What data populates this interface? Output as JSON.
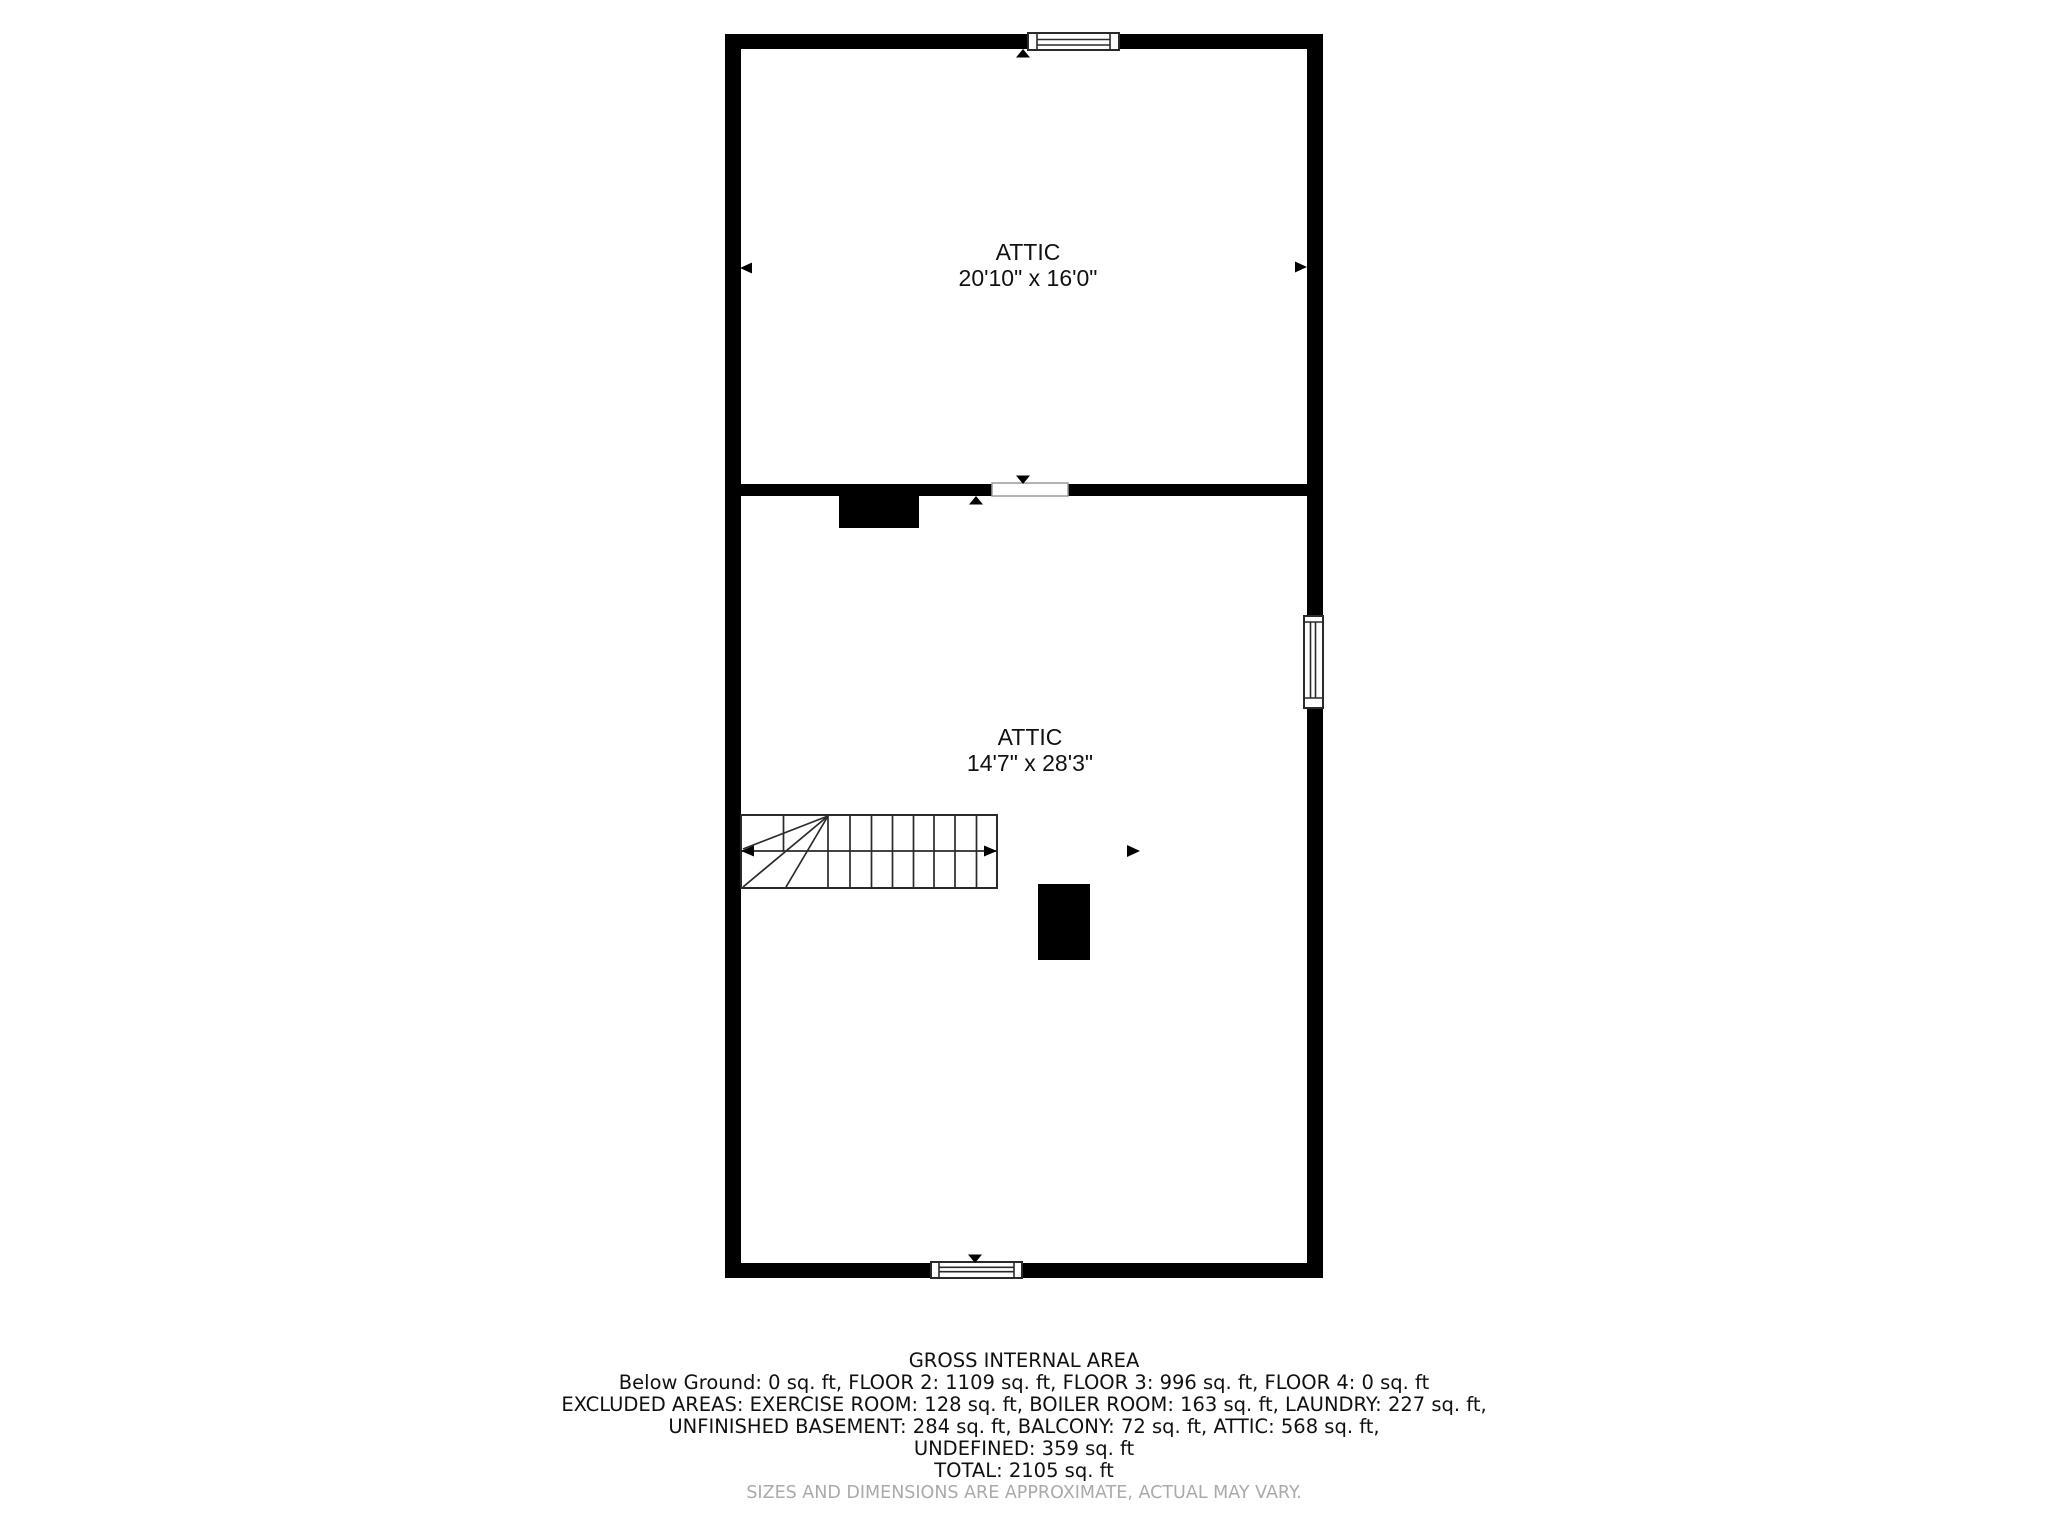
{
  "floor_plan": {
    "rooms": [
      {
        "name": "ATTIC",
        "dimensions": "20'10\" x 16'0\""
      },
      {
        "name": "ATTIC",
        "dimensions": "14'7\" x 28'3\""
      }
    ]
  },
  "summary": {
    "title": "GROSS INTERNAL AREA",
    "lines": [
      "Below Ground: 0 sq. ft, FLOOR 2: 1109 sq. ft, FLOOR 3: 996 sq. ft, FLOOR 4: 0 sq. ft",
      "EXCLUDED AREAS: EXERCISE ROOM: 128 sq. ft, BOILER ROOM: 163 sq. ft, LAUNDRY: 227 sq. ft,",
      "UNFINISHED BASEMENT: 284 sq. ft, BALCONY: 72 sq. ft, ATTIC: 568 sq. ft,",
      "UNDEFINED: 359 sq. ft",
      "TOTAL: 2105 sq. ft"
    ],
    "disclaimer": "SIZES AND DIMENSIONS ARE APPROXIMATE, ACTUAL MAY VARY."
  },
  "colors": {
    "wall": "#000000",
    "line": "#2a2a2a",
    "opening_border": "#9a9a9a",
    "background": "#ffffff",
    "text": "#111111",
    "disclaimer": "#aaaaaa"
  }
}
